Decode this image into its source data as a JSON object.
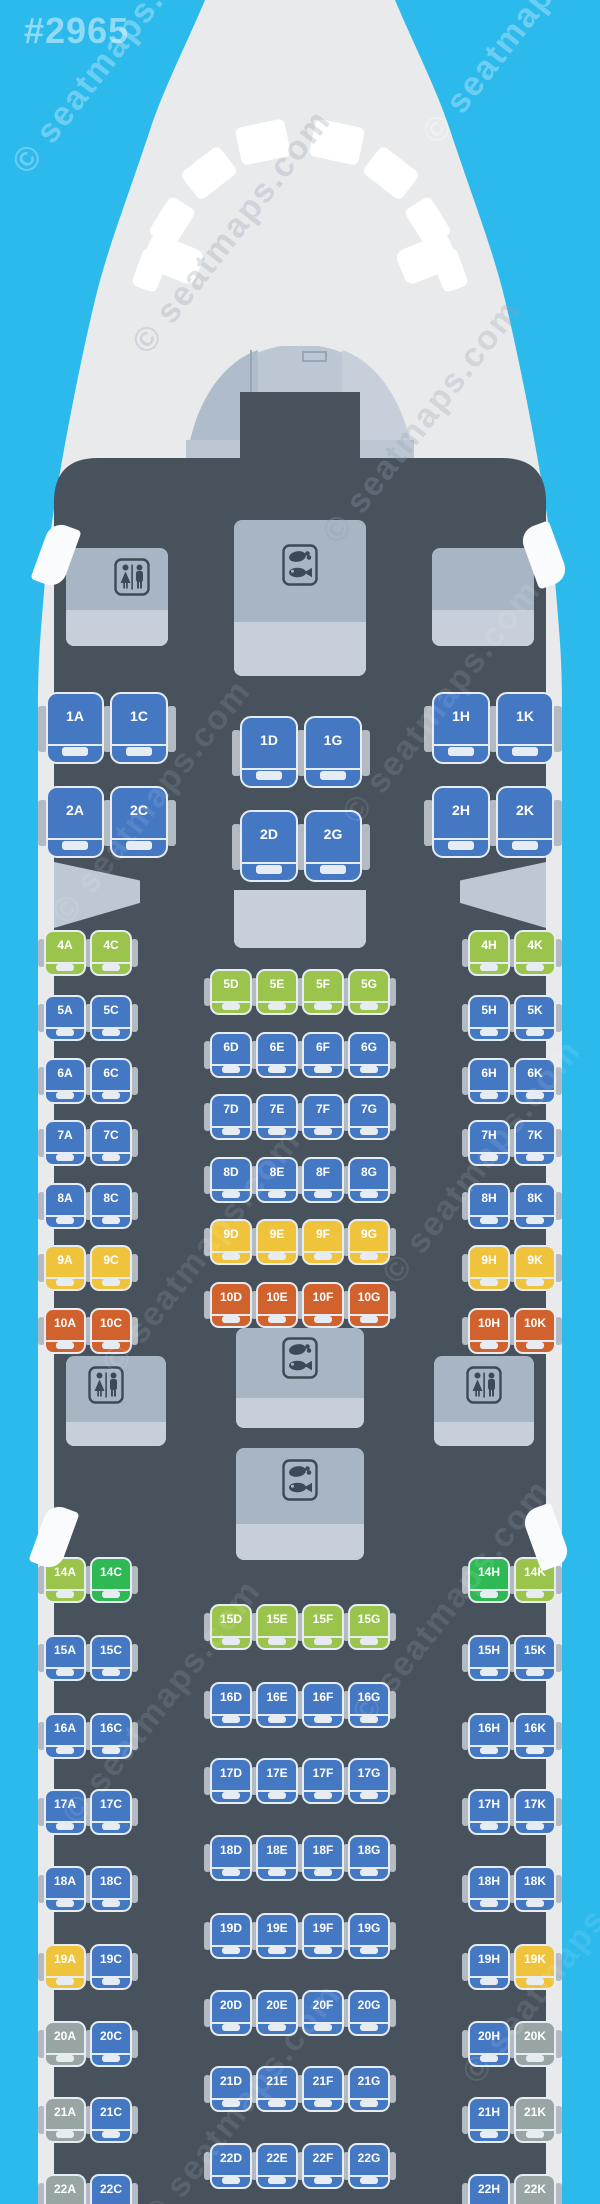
{
  "map_id": "#2965",
  "watermark": {
    "text": "© seatmaps.com"
  },
  "colors": {
    "background": "#2CB9EC",
    "fuselage": "#E8EAEC",
    "cabin": "#47525D",
    "cockpit_glass": "#FFFFFF",
    "cockpit_interior": "#BCC7D3",
    "cockpit_panel_dark": "#AEBCCC",
    "cockpit_panel_light": "#C6CFDA",
    "cockpit_line": "#98A6B6",
    "monument": "#A8B5C5",
    "monument_light": "#C6CFDA",
    "icon_dark": "#3D4955",
    "bulkhead": "#BDC8D4",
    "exit_marker": "#FAFBFC",
    "armrest": "#B3BAC2",
    "seat_blue": "#4478C3",
    "seat_lime": "#9AC44C",
    "seat_green": "#2EB955",
    "seat_yellow": "#EFC43C",
    "seat_orange": "#D2622D",
    "seat_gray": "#99A5A4"
  },
  "facilities": [
    {
      "name": "front-lavatory-left",
      "kind": "lavatory",
      "icon": "wc"
    },
    {
      "name": "front-galley-right",
      "kind": "galley",
      "icon": null
    },
    {
      "name": "front-galley-center",
      "kind": "galley",
      "icon": "meal"
    },
    {
      "name": "mid-galley-divider",
      "kind": "galley",
      "icon": null
    },
    {
      "name": "mid-lavatory-left",
      "kind": "lavatory",
      "icon": "wc"
    },
    {
      "name": "mid-lavatory-right",
      "kind": "lavatory",
      "icon": "wc"
    },
    {
      "name": "mid-galley-forward",
      "kind": "galley",
      "icon": "meal"
    },
    {
      "name": "mid-galley-aft",
      "kind": "galley",
      "icon": "meal"
    }
  ],
  "rows": [
    {
      "row": "1",
      "type": "business",
      "seats": [
        {
          "id": "1A",
          "color": "blue"
        },
        {
          "id": "1C",
          "color": "blue"
        },
        {
          "id": "1D",
          "color": "blue"
        },
        {
          "id": "1G",
          "color": "blue"
        },
        {
          "id": "1H",
          "color": "blue"
        },
        {
          "id": "1K",
          "color": "blue"
        }
      ]
    },
    {
      "row": "2",
      "type": "business",
      "seats": [
        {
          "id": "2A",
          "color": "blue"
        },
        {
          "id": "2C",
          "color": "blue"
        },
        {
          "id": "2D",
          "color": "blue"
        },
        {
          "id": "2G",
          "color": "blue"
        },
        {
          "id": "2H",
          "color": "blue"
        },
        {
          "id": "2K",
          "color": "blue"
        }
      ]
    },
    {
      "row": "4",
      "type": "economy",
      "seats": [
        {
          "id": "4A",
          "color": "lime"
        },
        {
          "id": "4C",
          "color": "lime"
        },
        {
          "id": "4H",
          "color": "lime"
        },
        {
          "id": "4K",
          "color": "lime"
        }
      ]
    },
    {
      "row": "5",
      "type": "economy",
      "seats": [
        {
          "id": "5A",
          "color": "blue"
        },
        {
          "id": "5C",
          "color": "blue"
        },
        {
          "id": "5D",
          "color": "lime"
        },
        {
          "id": "5E",
          "color": "lime"
        },
        {
          "id": "5F",
          "color": "lime"
        },
        {
          "id": "5G",
          "color": "lime"
        },
        {
          "id": "5H",
          "color": "blue"
        },
        {
          "id": "5K",
          "color": "blue"
        }
      ]
    },
    {
      "row": "6",
      "type": "economy",
      "seats": [
        {
          "id": "6A",
          "color": "blue"
        },
        {
          "id": "6C",
          "color": "blue"
        },
        {
          "id": "6D",
          "color": "blue"
        },
        {
          "id": "6E",
          "color": "blue"
        },
        {
          "id": "6F",
          "color": "blue"
        },
        {
          "id": "6G",
          "color": "blue"
        },
        {
          "id": "6H",
          "color": "blue"
        },
        {
          "id": "6K",
          "color": "blue"
        }
      ]
    },
    {
      "row": "7",
      "type": "economy",
      "seats": [
        {
          "id": "7A",
          "color": "blue"
        },
        {
          "id": "7C",
          "color": "blue"
        },
        {
          "id": "7D",
          "color": "blue"
        },
        {
          "id": "7E",
          "color": "blue"
        },
        {
          "id": "7F",
          "color": "blue"
        },
        {
          "id": "7G",
          "color": "blue"
        },
        {
          "id": "7H",
          "color": "blue"
        },
        {
          "id": "7K",
          "color": "blue"
        }
      ]
    },
    {
      "row": "8",
      "type": "economy",
      "seats": [
        {
          "id": "8A",
          "color": "blue"
        },
        {
          "id": "8C",
          "color": "blue"
        },
        {
          "id": "8D",
          "color": "blue"
        },
        {
          "id": "8E",
          "color": "blue"
        },
        {
          "id": "8F",
          "color": "blue"
        },
        {
          "id": "8G",
          "color": "blue"
        },
        {
          "id": "8H",
          "color": "blue"
        },
        {
          "id": "8K",
          "color": "blue"
        }
      ]
    },
    {
      "row": "9",
      "type": "economy",
      "seats": [
        {
          "id": "9A",
          "color": "yellow"
        },
        {
          "id": "9C",
          "color": "yellow"
        },
        {
          "id": "9D",
          "color": "yellow"
        },
        {
          "id": "9E",
          "color": "yellow"
        },
        {
          "id": "9F",
          "color": "yellow"
        },
        {
          "id": "9G",
          "color": "yellow"
        },
        {
          "id": "9H",
          "color": "yellow"
        },
        {
          "id": "9K",
          "color": "yellow"
        }
      ]
    },
    {
      "row": "10",
      "type": "economy",
      "seats": [
        {
          "id": "10A",
          "color": "orange"
        },
        {
          "id": "10C",
          "color": "orange"
        },
        {
          "id": "10D",
          "color": "orange"
        },
        {
          "id": "10E",
          "color": "orange"
        },
        {
          "id": "10F",
          "color": "orange"
        },
        {
          "id": "10G",
          "color": "orange"
        },
        {
          "id": "10H",
          "color": "orange"
        },
        {
          "id": "10K",
          "color": "orange"
        }
      ]
    },
    {
      "row": "14",
      "type": "economy",
      "seats": [
        {
          "id": "14A",
          "color": "lime"
        },
        {
          "id": "14C",
          "color": "green"
        },
        {
          "id": "14H",
          "color": "green"
        },
        {
          "id": "14K",
          "color": "lime"
        }
      ]
    },
    {
      "row": "15",
      "type": "economy",
      "seats": [
        {
          "id": "15A",
          "color": "blue"
        },
        {
          "id": "15C",
          "color": "blue"
        },
        {
          "id": "15D",
          "color": "lime"
        },
        {
          "id": "15E",
          "color": "lime"
        },
        {
          "id": "15F",
          "color": "lime"
        },
        {
          "id": "15G",
          "color": "lime"
        },
        {
          "id": "15H",
          "color": "blue"
        },
        {
          "id": "15K",
          "color": "blue"
        }
      ]
    },
    {
      "row": "16",
      "type": "economy",
      "seats": [
        {
          "id": "16A",
          "color": "blue"
        },
        {
          "id": "16C",
          "color": "blue"
        },
        {
          "id": "16D",
          "color": "blue"
        },
        {
          "id": "16E",
          "color": "blue"
        },
        {
          "id": "16F",
          "color": "blue"
        },
        {
          "id": "16G",
          "color": "blue"
        },
        {
          "id": "16H",
          "color": "blue"
        },
        {
          "id": "16K",
          "color": "blue"
        }
      ]
    },
    {
      "row": "17",
      "type": "economy",
      "seats": [
        {
          "id": "17A",
          "color": "blue"
        },
        {
          "id": "17C",
          "color": "blue"
        },
        {
          "id": "17D",
          "color": "blue"
        },
        {
          "id": "17E",
          "color": "blue"
        },
        {
          "id": "17F",
          "color": "blue"
        },
        {
          "id": "17G",
          "color": "blue"
        },
        {
          "id": "17H",
          "color": "blue"
        },
        {
          "id": "17K",
          "color": "blue"
        }
      ]
    },
    {
      "row": "18",
      "type": "economy",
      "seats": [
        {
          "id": "18A",
          "color": "blue"
        },
        {
          "id": "18C",
          "color": "blue"
        },
        {
          "id": "18D",
          "color": "blue"
        },
        {
          "id": "18E",
          "color": "blue"
        },
        {
          "id": "18F",
          "color": "blue"
        },
        {
          "id": "18G",
          "color": "blue"
        },
        {
          "id": "18H",
          "color": "blue"
        },
        {
          "id": "18K",
          "color": "blue"
        }
      ]
    },
    {
      "row": "19",
      "type": "economy",
      "seats": [
        {
          "id": "19A",
          "color": "yellow"
        },
        {
          "id": "19C",
          "color": "blue"
        },
        {
          "id": "19D",
          "color": "blue"
        },
        {
          "id": "19E",
          "color": "blue"
        },
        {
          "id": "19F",
          "color": "blue"
        },
        {
          "id": "19G",
          "color": "blue"
        },
        {
          "id": "19H",
          "color": "blue"
        },
        {
          "id": "19K",
          "color": "yellow"
        }
      ]
    },
    {
      "row": "20",
      "type": "economy",
      "seats": [
        {
          "id": "20A",
          "color": "gray"
        },
        {
          "id": "20C",
          "color": "blue"
        },
        {
          "id": "20D",
          "color": "blue"
        },
        {
          "id": "20E",
          "color": "blue"
        },
        {
          "id": "20F",
          "color": "blue"
        },
        {
          "id": "20G",
          "color": "blue"
        },
        {
          "id": "20H",
          "color": "blue"
        },
        {
          "id": "20K",
          "color": "gray"
        }
      ]
    },
    {
      "row": "21",
      "type": "economy",
      "seats": [
        {
          "id": "21A",
          "color": "gray"
        },
        {
          "id": "21C",
          "color": "blue"
        },
        {
          "id": "21D",
          "color": "blue"
        },
        {
          "id": "21E",
          "color": "blue"
        },
        {
          "id": "21F",
          "color": "blue"
        },
        {
          "id": "21G",
          "color": "blue"
        },
        {
          "id": "21H",
          "color": "blue"
        },
        {
          "id": "21K",
          "color": "gray"
        }
      ]
    },
    {
      "row": "22",
      "type": "economy",
      "seats": [
        {
          "id": "22A",
          "color": "gray"
        },
        {
          "id": "22C",
          "color": "blue"
        },
        {
          "id": "22D",
          "color": "blue"
        },
        {
          "id": "22E",
          "color": "blue"
        },
        {
          "id": "22F",
          "color": "blue"
        },
        {
          "id": "22G",
          "color": "blue"
        },
        {
          "id": "22H",
          "color": "blue"
        },
        {
          "id": "22K",
          "color": "gray"
        }
      ]
    }
  ]
}
